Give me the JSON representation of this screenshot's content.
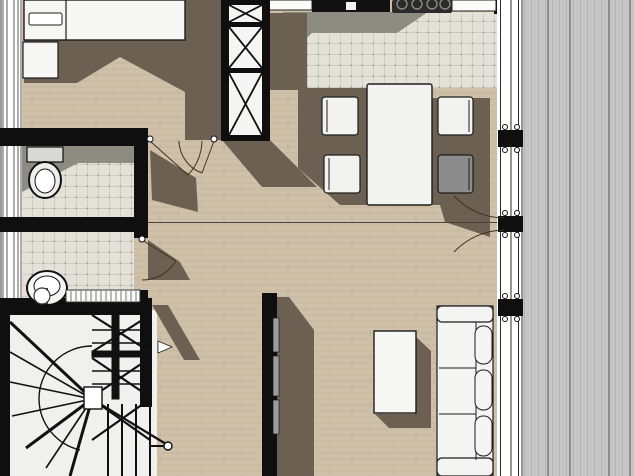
{
  "view": {
    "width": 634,
    "height": 476,
    "kind": "architectural-floor-plan",
    "text_visible": false
  },
  "colors": {
    "wall": "#0f0f0f",
    "wood": "#cfc1a9",
    "wood_line": "#b9a891",
    "wood_shadow": "#6c6053",
    "tile": "#e4e2d8",
    "tile_line": "#c9c6ba",
    "tile_dot": "#97958a",
    "tile_shadow": "#8d8c83",
    "deck": "#c7c7c7",
    "deck_line": "#b2b2b2",
    "deck_joint": "#8e8e8e",
    "glass": "#ffffff",
    "frame_line": "#2b2b2b",
    "furn_fill": "#f4f4f2",
    "furn_stroke": "#1c1c1c",
    "chair_gray": "#8c8c8c",
    "tv_gray": "#9c9c9a",
    "counter_black": "#111111",
    "cooktop": "#2b2b29",
    "burner_ring": "#8a8a88",
    "stairs_bg": "#f0f0ee",
    "door_arc": "#41301f",
    "seam": "#4a4038",
    "window_edge": "#9a9a9a"
  },
  "rooms": [
    {
      "name": "bedroom",
      "floor": "wood"
    },
    {
      "name": "wc",
      "floor": "tile"
    },
    {
      "name": "bathroom",
      "floor": "tile"
    },
    {
      "name": "kitchen",
      "floor": "tile"
    },
    {
      "name": "dining-area",
      "floor": "wood"
    },
    {
      "name": "living-area",
      "floor": "wood"
    },
    {
      "name": "hallway",
      "floor": "wood"
    },
    {
      "name": "staircase",
      "floor": "painted"
    },
    {
      "name": "deck",
      "floor": "decking-boards"
    }
  ],
  "furniture": [
    {
      "name": "double-bed",
      "count": 1
    },
    {
      "name": "pillow",
      "count": 1
    },
    {
      "name": "nightstand",
      "count": 1
    },
    {
      "name": "wardrobe-cross-braced",
      "count": 1
    },
    {
      "name": "kitchen-counter",
      "count": 1
    },
    {
      "name": "counter-sink",
      "count": 1
    },
    {
      "name": "cooktop-4-burner",
      "count": 1
    },
    {
      "name": "dining-table",
      "count": 1
    },
    {
      "name": "dining-chair-white",
      "count": 3
    },
    {
      "name": "dining-chair-gray",
      "count": 1
    },
    {
      "name": "sofa-3-seat",
      "count": 1
    },
    {
      "name": "coffee-table",
      "count": 1
    },
    {
      "name": "tv-on-partition-wall",
      "count": 1
    },
    {
      "name": "toilet",
      "count": 1
    },
    {
      "name": "washbasin",
      "count": 1
    },
    {
      "name": "radiator",
      "count": 1
    },
    {
      "name": "winder-staircase",
      "count": 1
    },
    {
      "name": "glazed-wall-with-posts",
      "count": 1
    }
  ]
}
